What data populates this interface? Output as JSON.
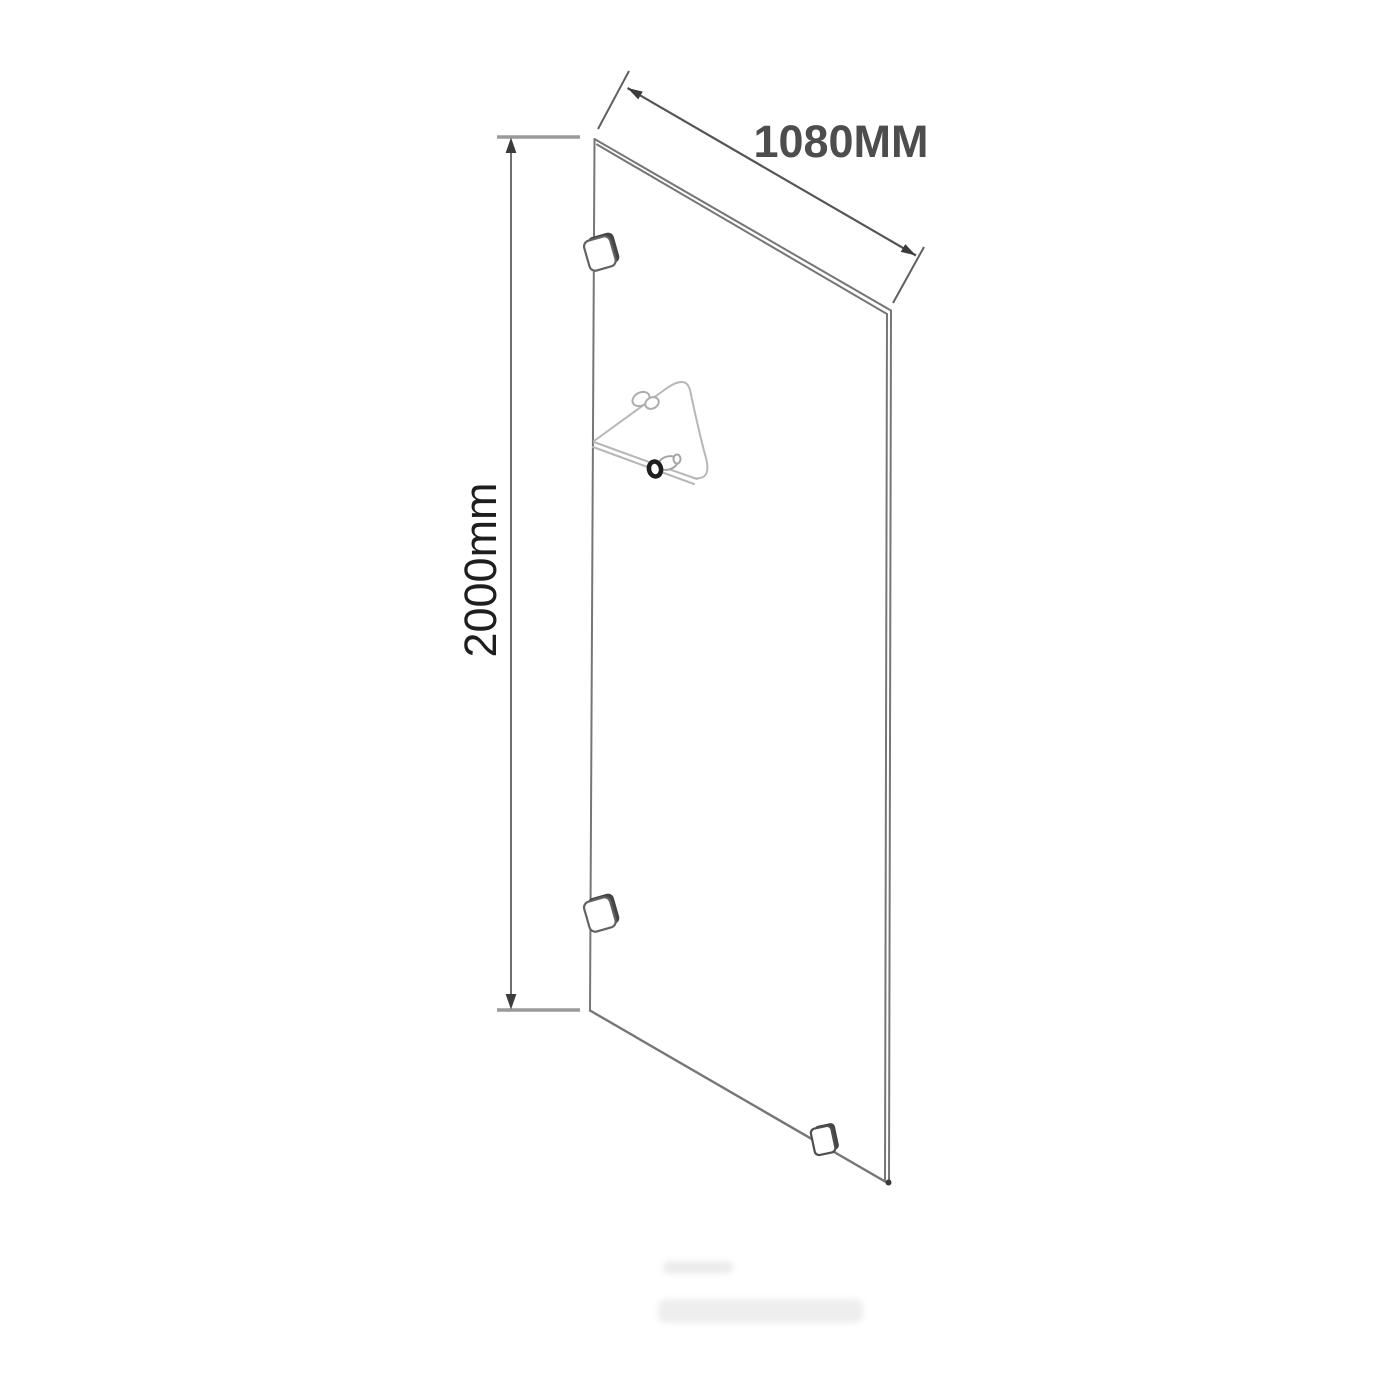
{
  "diagram": {
    "width_label": "1080MM",
    "height_label": "2000mm",
    "colors": {
      "background": "#ffffff",
      "panel_line": "#767676",
      "dimension_line": "#5a5a5a",
      "extension_line": "#9a9a9a",
      "arrow_fill": "#3c3c3c",
      "width_label_color": "#4d4d4d",
      "height_label_color": "#1e1e1e",
      "shelf_line": "#b7b7b7",
      "bracket_depth": "#454545",
      "knob_ring": "#1e1e1e"
    },
    "parts": {
      "panel": "glass-panel",
      "bracket_top": "wall-bracket-top",
      "bracket_bottom": "wall-bracket-bottom",
      "floor_clamp": "floor-bracket",
      "shelf": "corner-shelf-bracket",
      "icons": [
        "arrow-up-icon",
        "arrow-down-icon",
        "arrow-upper-left-icon",
        "arrow-lower-right-icon"
      ]
    }
  }
}
